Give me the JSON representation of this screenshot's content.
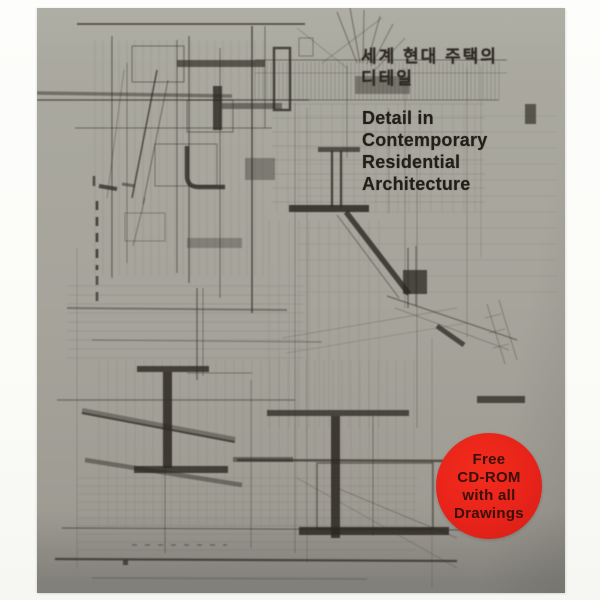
{
  "cover": {
    "korean_title": [
      "세계 현대 주택의",
      "디테일"
    ],
    "english_title": [
      "Detail in",
      "Contemporary",
      "Residential",
      "Architecture"
    ],
    "badge_lines": [
      "Free",
      "CD-ROM",
      "with all",
      "Drawings"
    ],
    "colors": {
      "cover_background": "#a6a49b",
      "drawing_ink": "#2b2721",
      "title_text": "#221e18",
      "badge_red": "#e8231a",
      "badge_text": "#3a1009",
      "page_white": "#fcfcfa"
    }
  }
}
